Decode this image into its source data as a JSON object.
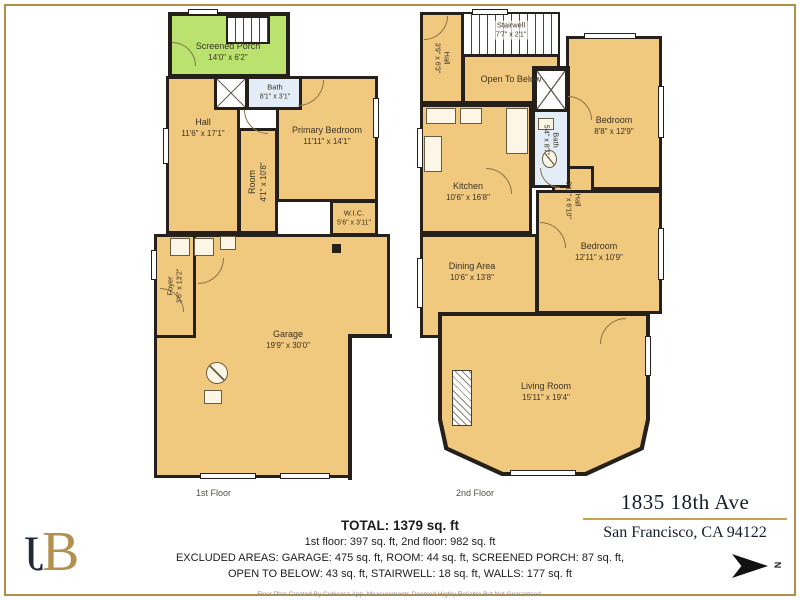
{
  "colors": {
    "wall": "#26201a",
    "floor": "#f0c87e",
    "porch": "#b9e26f",
    "bath": "#e2edf7",
    "accent_gold": "#b28e4a"
  },
  "floor1": {
    "label": "1st Floor",
    "rooms": [
      {
        "name": "Screened Porch",
        "dims": "14'0\" x 6'2\""
      },
      {
        "name": "Bath",
        "dims": "8'1\" x 3'1\""
      },
      {
        "name": "Hall",
        "dims": "11'6\" x 17'1\""
      },
      {
        "name": "Room",
        "dims": "4'1\" x 10'8\""
      },
      {
        "name": "Primary Bedroom",
        "dims": "11'11\" x 14'1\""
      },
      {
        "name": "W.I.C.",
        "dims": "5'6\" x 3'11\""
      },
      {
        "name": "Foyer",
        "dims": "3'6\" x 13'2\""
      },
      {
        "name": "Garage",
        "dims": "19'9\" x 30'0\""
      }
    ]
  },
  "floor2": {
    "label": "2nd Floor",
    "rooms": [
      {
        "name": "Stairwell",
        "dims": "7'7\" x 2'1\""
      },
      {
        "name": "Open To Below",
        "dims": ""
      },
      {
        "name": "Hall",
        "dims": "3'9\" x 6'3\""
      },
      {
        "name": "Bath",
        "dims": "5'4\" x 8'7\""
      },
      {
        "name": "Kitchen",
        "dims": "10'6\" x 16'8\""
      },
      {
        "name": "Bedroom",
        "dims": "8'8\" x 12'9\""
      },
      {
        "name": "Hall",
        "dims": "3'11\" x 6'10\""
      },
      {
        "name": "Dining Area",
        "dims": "10'6\" x 13'8\""
      },
      {
        "name": "Bedroom",
        "dims": "12'11\" x 10'9\""
      },
      {
        "name": "Living Room",
        "dims": "15'11\" x 19'4\""
      }
    ]
  },
  "summary": {
    "total": "TOTAL: 1379 sq. ft",
    "floors": "1st floor: 397 sq. ft, 2nd floor: 982 sq. ft",
    "excluded1": "EXCLUDED AREAS: GARAGE: 475 sq. ft, ROOM: 44 sq. ft, SCREENED PORCH: 87 sq. ft,",
    "excluded2": "OPEN TO BELOW: 43 sq. ft, STAIRWELL: 18 sq. ft, WALLS: 177 sq. ft",
    "disclaimer": "Floor Plan Created By Cubicasa App. Measurements Deemed Highly Reliable But Not Guaranteed."
  },
  "address": {
    "line1": "1835 18th Ave",
    "line2": "San Francisco, CA 94122"
  },
  "compass": {
    "label": "N"
  },
  "logo": {
    "letter_j": "J",
    "letter_b": "B"
  }
}
